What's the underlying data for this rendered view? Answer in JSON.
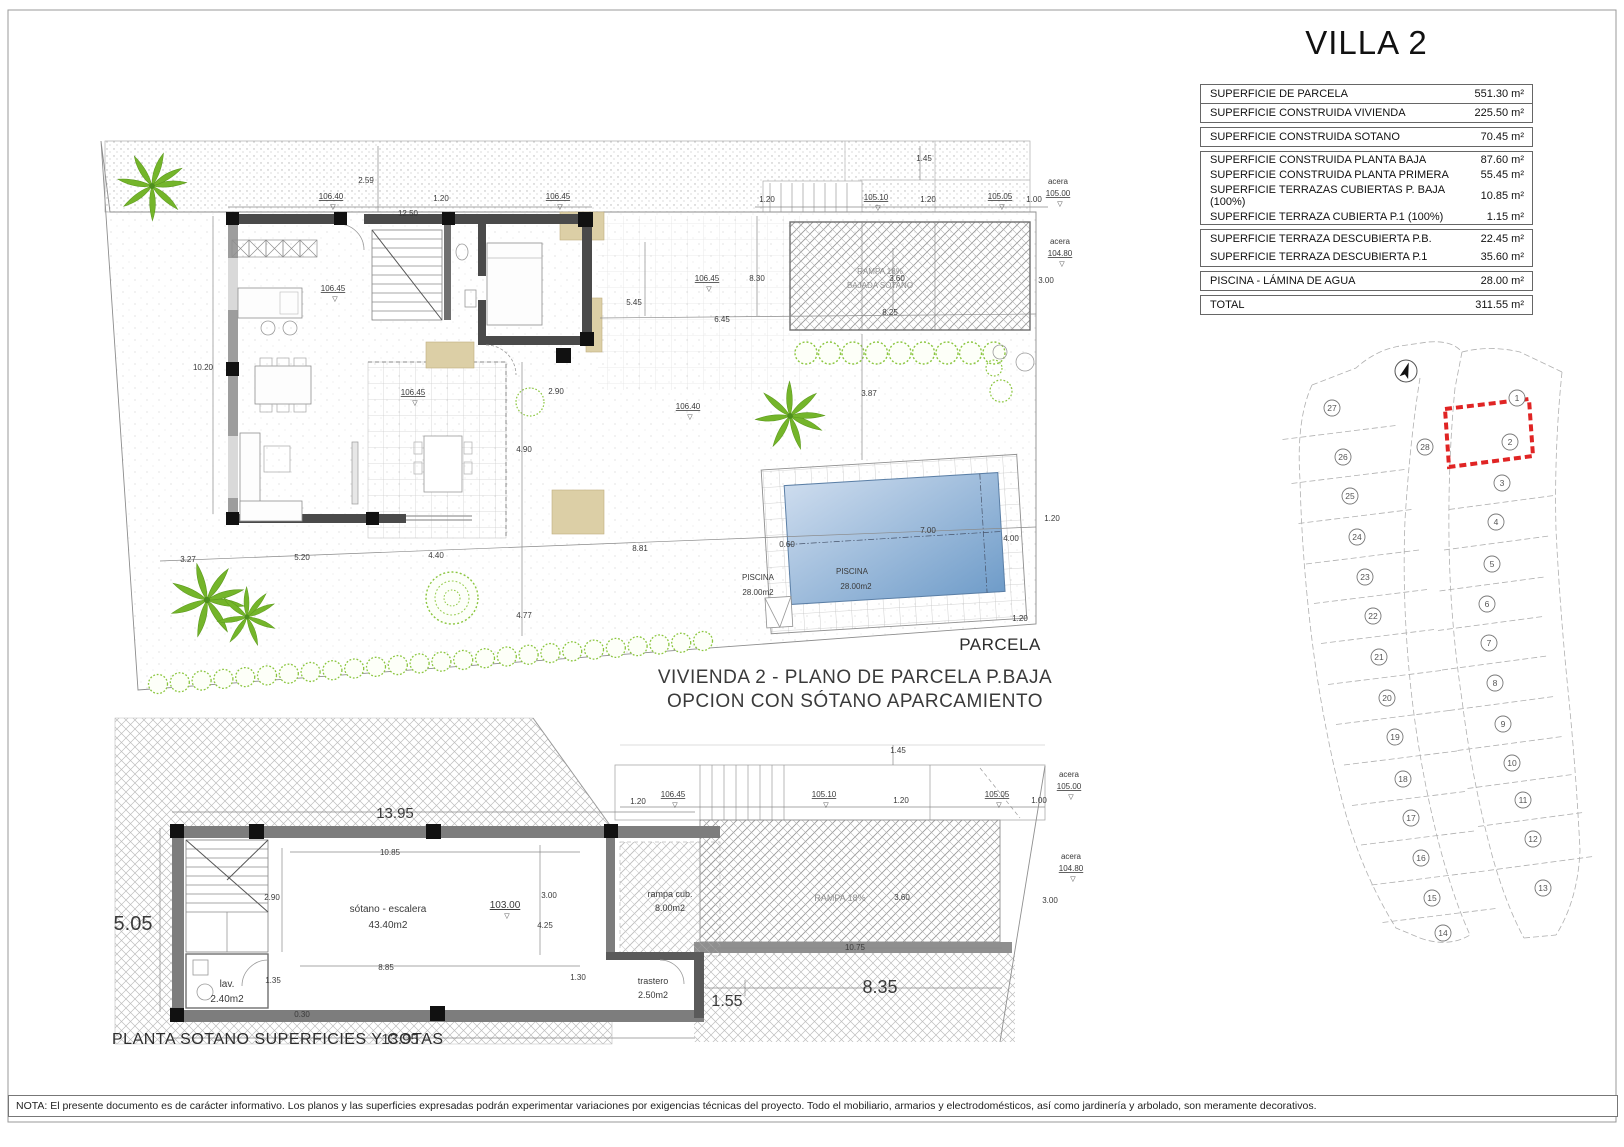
{
  "header": {
    "title": "VILLA 2"
  },
  "summary_table": {
    "groups": [
      {
        "rows": [
          {
            "label": "SUPERFICIE DE PARCELA",
            "value": "551.30 m²"
          },
          {
            "label": "SUPERFICIE CONSTRUIDA VIVIENDA",
            "value": "225.50 m²"
          }
        ]
      },
      {
        "rows": [
          {
            "label": "SUPERFICIE CONSTRUIDA SOTANO",
            "value": "70.45 m²"
          }
        ]
      },
      {
        "rows": [
          {
            "label": "SUPERFICIE CONSTRUIDA PLANTA BAJA",
            "value": "87.60 m²"
          },
          {
            "label": "SUPERFICIE CONSTRUIDA PLANTA PRIMERA",
            "value": "55.45 m²"
          },
          {
            "label": "SUPERFICIE TERRAZAS CUBIERTAS P. BAJA (100%)",
            "value": "10.85 m²"
          },
          {
            "label": "SUPERFICIE TERRAZA CUBIERTA P.1 (100%)",
            "value": "1.15 m²"
          }
        ]
      },
      {
        "rows": [
          {
            "label": "SUPERFICIE TERRAZA DESCUBIERTA P.B.",
            "value": "22.45 m²"
          },
          {
            "label": "SUPERFICIE TERRAZA DESCUBIERTA P.1",
            "value": "35.60 m²"
          }
        ]
      },
      {
        "rows": [
          {
            "label": "PISCINA - LÁMINA DE AGUA",
            "value": "28.00 m²"
          }
        ]
      },
      {
        "rows": [
          {
            "label": "TOTAL",
            "value": "311.55 m²"
          }
        ]
      }
    ]
  },
  "captions": {
    "parcela": "PARCELA",
    "baja_line1": "VIVIENDA 2 - PLANO DE PARCELA P.BAJA",
    "baja_line2": "OPCION CON SÓTANO APARCAMIENTO",
    "sotano": "PLANTA SOTANO SUPERFICIES Y COTAS"
  },
  "note": {
    "text": "NOTA: El presente documento es de carácter informativo. Los planos y las superficies expresadas podrán experimentar variaciones por exigencias técnicas del proyecto. Todo el mobiliario, armarios y electrodomésticos, así como jardinería y arbolado, son meramente decorativos."
  },
  "plan_baja": {
    "labels": [
      {
        "t": "2.59",
        "x": 366,
        "y": 183
      },
      {
        "t": "106.40",
        "x": 331,
        "y": 199,
        "lv": 1
      },
      {
        "t": "12.50",
        "x": 408,
        "y": 216
      },
      {
        "t": "1.20",
        "x": 441,
        "y": 201
      },
      {
        "t": "106.45",
        "x": 558,
        "y": 199,
        "lv": 1
      },
      {
        "t": "1.45",
        "x": 924,
        "y": 161
      },
      {
        "t": "1.20",
        "x": 767,
        "y": 202
      },
      {
        "t": "105.10",
        "x": 876,
        "y": 200,
        "lv": 1
      },
      {
        "t": "1.20",
        "x": 928,
        "y": 202
      },
      {
        "t": "105.05",
        "x": 1000,
        "y": 199,
        "lv": 1
      },
      {
        "t": "1.00",
        "x": 1034,
        "y": 202
      },
      {
        "t": "acera",
        "x": 1058,
        "y": 184
      },
      {
        "t": "105.00",
        "x": 1058,
        "y": 196,
        "lv": 1
      },
      {
        "t": "acera",
        "x": 1060,
        "y": 244
      },
      {
        "t": "104.80",
        "x": 1060,
        "y": 256,
        "lv": 1
      },
      {
        "t": "10.20",
        "x": 203,
        "y": 370
      },
      {
        "t": "106.45",
        "x": 333,
        "y": 291,
        "lv": 1
      },
      {
        "t": "5.45",
        "x": 634,
        "y": 305
      },
      {
        "t": "106.45",
        "x": 707,
        "y": 281,
        "lv": 1
      },
      {
        "t": "8.30",
        "x": 757,
        "y": 281
      },
      {
        "t": "6.45",
        "x": 722,
        "y": 322
      },
      {
        "t": "3.60",
        "x": 897,
        "y": 281
      },
      {
        "t": "3.00",
        "x": 1046,
        "y": 283
      },
      {
        "t": "8.25",
        "x": 890,
        "y": 315
      },
      {
        "t": "106.45",
        "x": 413,
        "y": 395,
        "lv": 1
      },
      {
        "t": "2.90",
        "x": 556,
        "y": 394
      },
      {
        "t": "106.40",
        "x": 688,
        "y": 409,
        "lv": 1
      },
      {
        "t": "3.87",
        "x": 869,
        "y": 396
      },
      {
        "t": "4.90",
        "x": 524,
        "y": 452
      },
      {
        "t": "3.27",
        "x": 188,
        "y": 562
      },
      {
        "t": "5.20",
        "x": 302,
        "y": 560
      },
      {
        "t": "4.40",
        "x": 436,
        "y": 558
      },
      {
        "t": "8.81",
        "x": 640,
        "y": 551
      },
      {
        "t": "4.77",
        "x": 524,
        "y": 618
      },
      {
        "t": "0.60",
        "x": 787,
        "y": 547
      },
      {
        "t": "7.00",
        "x": 928,
        "y": 533
      },
      {
        "t": "4.00",
        "x": 1011,
        "y": 541
      },
      {
        "t": "1.20",
        "x": 1052,
        "y": 521
      },
      {
        "t": "1.20",
        "x": 1020,
        "y": 621
      },
      {
        "t": "PISCINA",
        "x": 758,
        "y": 580
      },
      {
        "t": "28.00m2",
        "x": 758,
        "y": 595
      },
      {
        "t": "PISCINA",
        "x": 852,
        "y": 574
      },
      {
        "t": "28.00m2",
        "x": 856,
        "y": 589
      },
      {
        "t": "RAMPA 18%",
        "x": 880,
        "y": 274,
        "c": "g"
      },
      {
        "t": "BAJADA SÓTANO",
        "x": 880,
        "y": 288,
        "c": "g"
      }
    ]
  },
  "plan_sotano": {
    "labels": [
      {
        "t": "13.95",
        "x": 395,
        "y": 818,
        "s": 15
      },
      {
        "t": "10.85",
        "x": 390,
        "y": 855
      },
      {
        "t": "2.90",
        "x": 272,
        "y": 900
      },
      {
        "t": "5.05",
        "x": 133,
        "y": 930,
        "s": 20
      },
      {
        "t": "sótano - escalera",
        "x": 388,
        "y": 912,
        "s": 10
      },
      {
        "t": "43.40m2",
        "x": 388,
        "y": 928,
        "s": 10
      },
      {
        "t": "103.00",
        "x": 505,
        "y": 908,
        "lv": 1,
        "s": 10
      },
      {
        "t": "3.00",
        "x": 549,
        "y": 898
      },
      {
        "t": "4.25",
        "x": 545,
        "y": 928
      },
      {
        "t": "1.35",
        "x": 273,
        "y": 983
      },
      {
        "t": "8.85",
        "x": 386,
        "y": 970
      },
      {
        "t": "1.30",
        "x": 578,
        "y": 980
      },
      {
        "t": "0.30",
        "x": 302,
        "y": 1017
      },
      {
        "t": "lav.",
        "x": 227,
        "y": 987,
        "s": 10
      },
      {
        "t": "2.40m2",
        "x": 227,
        "y": 1002,
        "s": 10
      },
      {
        "t": "13.95",
        "x": 400,
        "y": 1044,
        "s": 15
      },
      {
        "t": "trastero",
        "x": 653,
        "y": 984,
        "s": 9
      },
      {
        "t": "2.50m2",
        "x": 653,
        "y": 998,
        "s": 9
      },
      {
        "t": "rampa cub.",
        "x": 670,
        "y": 897,
        "s": 9
      },
      {
        "t": "8.00m2",
        "x": 670,
        "y": 911,
        "s": 9
      },
      {
        "t": "RAMPA 18%",
        "x": 840,
        "y": 901,
        "c": "g",
        "s": 9
      },
      {
        "t": "3.60",
        "x": 902,
        "y": 900
      },
      {
        "t": "10.75",
        "x": 855,
        "y": 950
      },
      {
        "t": "1.55",
        "x": 727,
        "y": 1006,
        "s": 16
      },
      {
        "t": "8.35",
        "x": 880,
        "y": 993,
        "s": 18
      },
      {
        "t": "1.45",
        "x": 898,
        "y": 753
      },
      {
        "t": "1.20",
        "x": 638,
        "y": 804
      },
      {
        "t": "106.45",
        "x": 673,
        "y": 797,
        "lv": 1
      },
      {
        "t": "105.10",
        "x": 824,
        "y": 797,
        "lv": 1
      },
      {
        "t": "1.20",
        "x": 901,
        "y": 803
      },
      {
        "t": "105.05",
        "x": 997,
        "y": 797,
        "lv": 1
      },
      {
        "t": "1.00",
        "x": 1039,
        "y": 803
      },
      {
        "t": "acera",
        "x": 1069,
        "y": 777
      },
      {
        "t": "105.00",
        "x": 1069,
        "y": 789,
        "lv": 1
      },
      {
        "t": "acera",
        "x": 1071,
        "y": 859
      },
      {
        "t": "104.80",
        "x": 1071,
        "y": 871,
        "lv": 1
      },
      {
        "t": "3.00",
        "x": 1050,
        "y": 903
      }
    ]
  },
  "site_plan": {
    "highlighted_parcel": 2,
    "highlight_color": "#e02424",
    "parcels": [
      {
        "n": 1,
        "x": 1517,
        "y": 398
      },
      {
        "n": 2,
        "x": 1510,
        "y": 442
      },
      {
        "n": 3,
        "x": 1502,
        "y": 483
      },
      {
        "n": 4,
        "x": 1496,
        "y": 522
      },
      {
        "n": 5,
        "x": 1492,
        "y": 564
      },
      {
        "n": 6,
        "x": 1487,
        "y": 604
      },
      {
        "n": 7,
        "x": 1489,
        "y": 643
      },
      {
        "n": 8,
        "x": 1495,
        "y": 683
      },
      {
        "n": 9,
        "x": 1503,
        "y": 724
      },
      {
        "n": 10,
        "x": 1512,
        "y": 763
      },
      {
        "n": 11,
        "x": 1523,
        "y": 800
      },
      {
        "n": 12,
        "x": 1533,
        "y": 839
      },
      {
        "n": 13,
        "x": 1543,
        "y": 888
      },
      {
        "n": 14,
        "x": 1443,
        "y": 933
      },
      {
        "n": 15,
        "x": 1432,
        "y": 898
      },
      {
        "n": 16,
        "x": 1421,
        "y": 858
      },
      {
        "n": 17,
        "x": 1411,
        "y": 818
      },
      {
        "n": 18,
        "x": 1403,
        "y": 779
      },
      {
        "n": 19,
        "x": 1395,
        "y": 737
      },
      {
        "n": 20,
        "x": 1387,
        "y": 698
      },
      {
        "n": 21,
        "x": 1379,
        "y": 657
      },
      {
        "n": 22,
        "x": 1373,
        "y": 616
      },
      {
        "n": 23,
        "x": 1365,
        "y": 577
      },
      {
        "n": 24,
        "x": 1357,
        "y": 537
      },
      {
        "n": 25,
        "x": 1350,
        "y": 496
      },
      {
        "n": 26,
        "x": 1343,
        "y": 457
      },
      {
        "n": 27,
        "x": 1332,
        "y": 408
      },
      {
        "n": 28,
        "x": 1425,
        "y": 447
      }
    ]
  }
}
